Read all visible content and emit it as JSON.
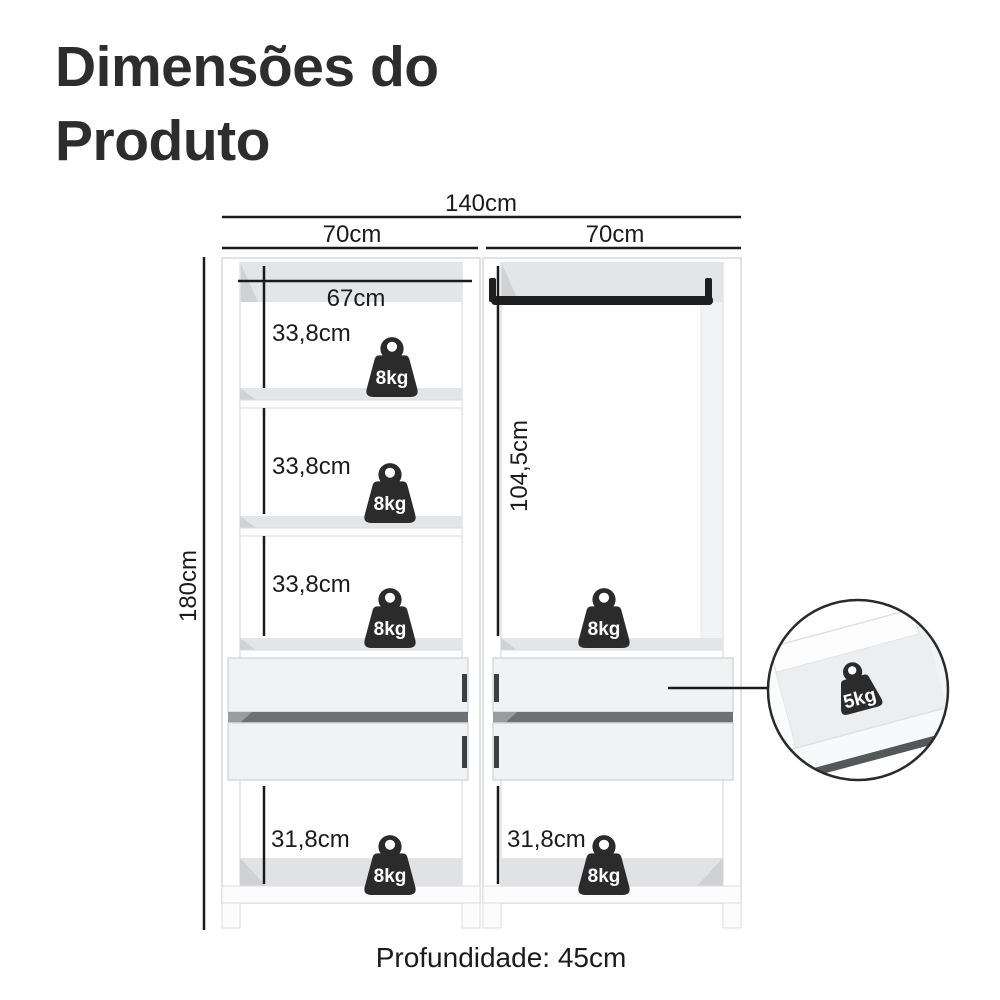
{
  "title": {
    "line1": "Dimensões do",
    "line2": "Produto"
  },
  "dimensions": {
    "total_width": "140cm",
    "left_module_width": "70cm",
    "right_module_width": "70cm",
    "shelf_inner_width": "67cm",
    "shelf_sections": [
      "33,8cm",
      "33,8cm",
      "33,8cm"
    ],
    "total_height": "180cm",
    "hanging_space_height": "104,5cm",
    "bottom_sections": [
      "31,8cm",
      "31,8cm"
    ],
    "depth_note": "Profundidade: 45cm"
  },
  "weights": {
    "shelf_labels": [
      "8kg",
      "8kg",
      "8kg",
      "8kg",
      "8kg",
      "8kg"
    ],
    "drawer_label": "5kg"
  },
  "colors": {
    "background": "#ffffff",
    "title_text": "#2d2d2e",
    "dimension_line": "#1a1a1a",
    "weight_icon": "#2b2b2b",
    "weight_text": "#ffffff",
    "furniture_outline": "#d7d8da",
    "furniture_shade": "#e4e5e6",
    "drawer_gap": "#6e7174",
    "rod": "#1f1f1f"
  }
}
